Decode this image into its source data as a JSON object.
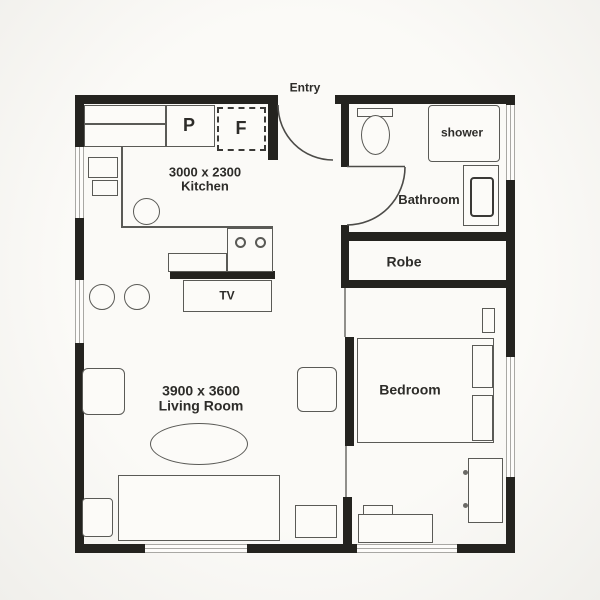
{
  "plan": {
    "entry_label": "Entry",
    "kitchen": {
      "dims": "3000 x 2300",
      "name": "Kitchen"
    },
    "living_room": {
      "dims": "3900 x 3600",
      "name": "Living Room"
    },
    "bathroom": {
      "name": "Bathroom"
    },
    "robe": {
      "name": "Robe"
    },
    "bedroom": {
      "name": "Bedroom"
    },
    "labels": {
      "pantry": "P",
      "fridge": "F",
      "tv": "TV",
      "shower": "shower"
    },
    "colors": {
      "wall": "#24231f",
      "furniture_line": "#5a5a56",
      "window": "#a9a8a4",
      "background": "#f6f5f1",
      "text": "#2d2c29"
    }
  }
}
